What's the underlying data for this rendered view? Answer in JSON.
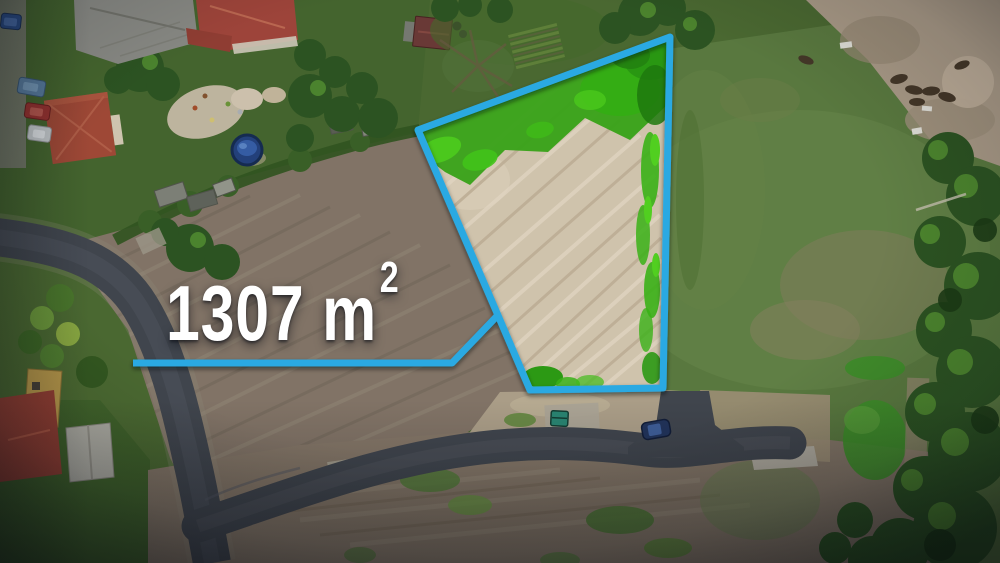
{
  "annotation": {
    "full_label": "1307 m²",
    "area_text": "1307 m",
    "area_superscript": "2",
    "accent_color": "#2aa9e2",
    "text_color": "#ffffff"
  },
  "scene": {
    "type": "aerial-drone-photo",
    "subject": "highlighted-building-plot-with-area-callout",
    "palette": {
      "grass_base": "#4d6c31",
      "grass_right_field": "#5d7d40",
      "dirt_field": "#877869",
      "plot_sand": "#daccb3",
      "plot_green": "#3aa916",
      "road_asphalt": "#43474e",
      "paddock_sand": "#b0a08b",
      "tree_dark": "#2e5621",
      "roof_red": "#a5463a",
      "roof_gray": "#8e8e87",
      "pool_blue": "#24427e",
      "car_navy": "#22345c",
      "container_teal": "#2b8a74"
    }
  }
}
